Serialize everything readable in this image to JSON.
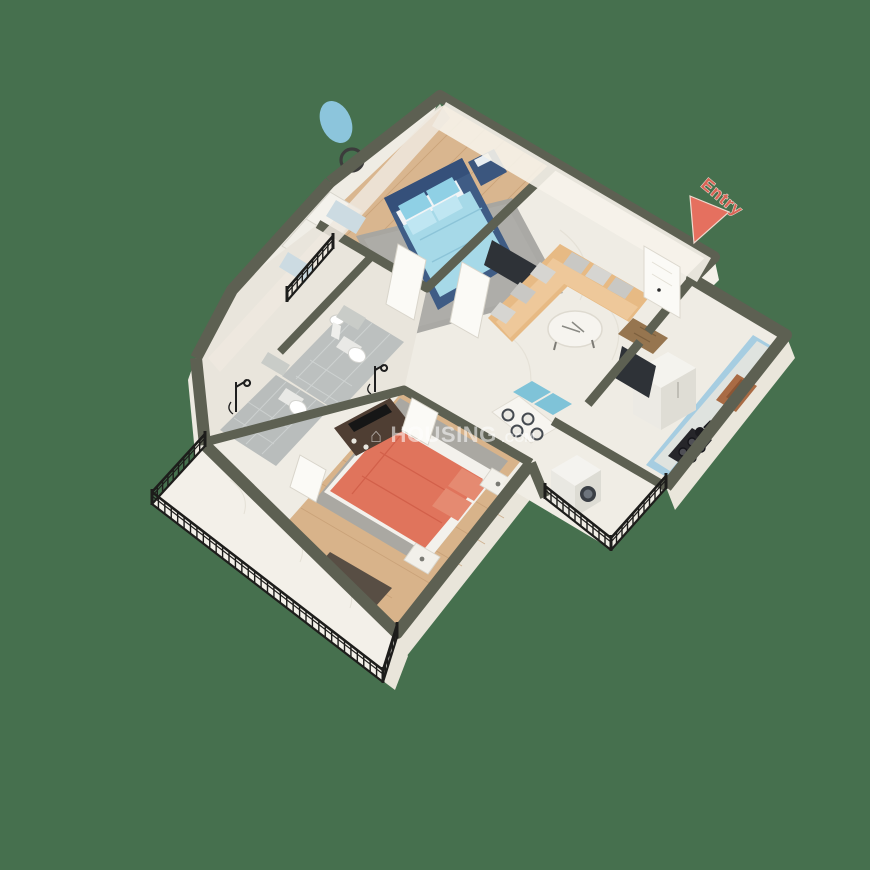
{
  "scene": {
    "description": "3D isometric rendered floor plan of a 2BHK apartment on plain green backdrop",
    "background_color": "#46704e"
  },
  "entry": {
    "label": "Entry",
    "label_color": "#d96456",
    "arrow_color": "#e5705f"
  },
  "watermark": {
    "house_icon": "⌂",
    "brand": "HOUSING",
    "tld": ".COM"
  },
  "palette": {
    "wall_top": "#5d6052",
    "wall_face": "#f2efe7",
    "wall_face_shade": "#e7e3d8",
    "marble_floor": "#efece4",
    "wood_floor_master": "#d9b68f",
    "wood_floor_bedroom2": "#d8b38a",
    "bathroom_tile": "#bcc0bf",
    "master_bed_frame": "#3f5c85",
    "master_bed_duvet": "#a6d9e8",
    "bedroom2_duvet": "#e0745c",
    "sofa": "#e7ba84",
    "sofa_pillow": "#c9c8c4",
    "dining_chair": "#7fc3d8",
    "kitchen_counter": "#a6cde1",
    "sink_copper": "#a96b44",
    "stove_black": "#26262a",
    "appliance_white": "#efeee9",
    "railing_black": "#1d1d1b",
    "rug_grey": "#a5a5a1",
    "tv_dark": "#2e3237",
    "doormat": "#96754f",
    "floor_mat_brown": "#584e44",
    "cabinet_brown": "#4f3e33",
    "glass_blue": "#c8dbe3"
  }
}
